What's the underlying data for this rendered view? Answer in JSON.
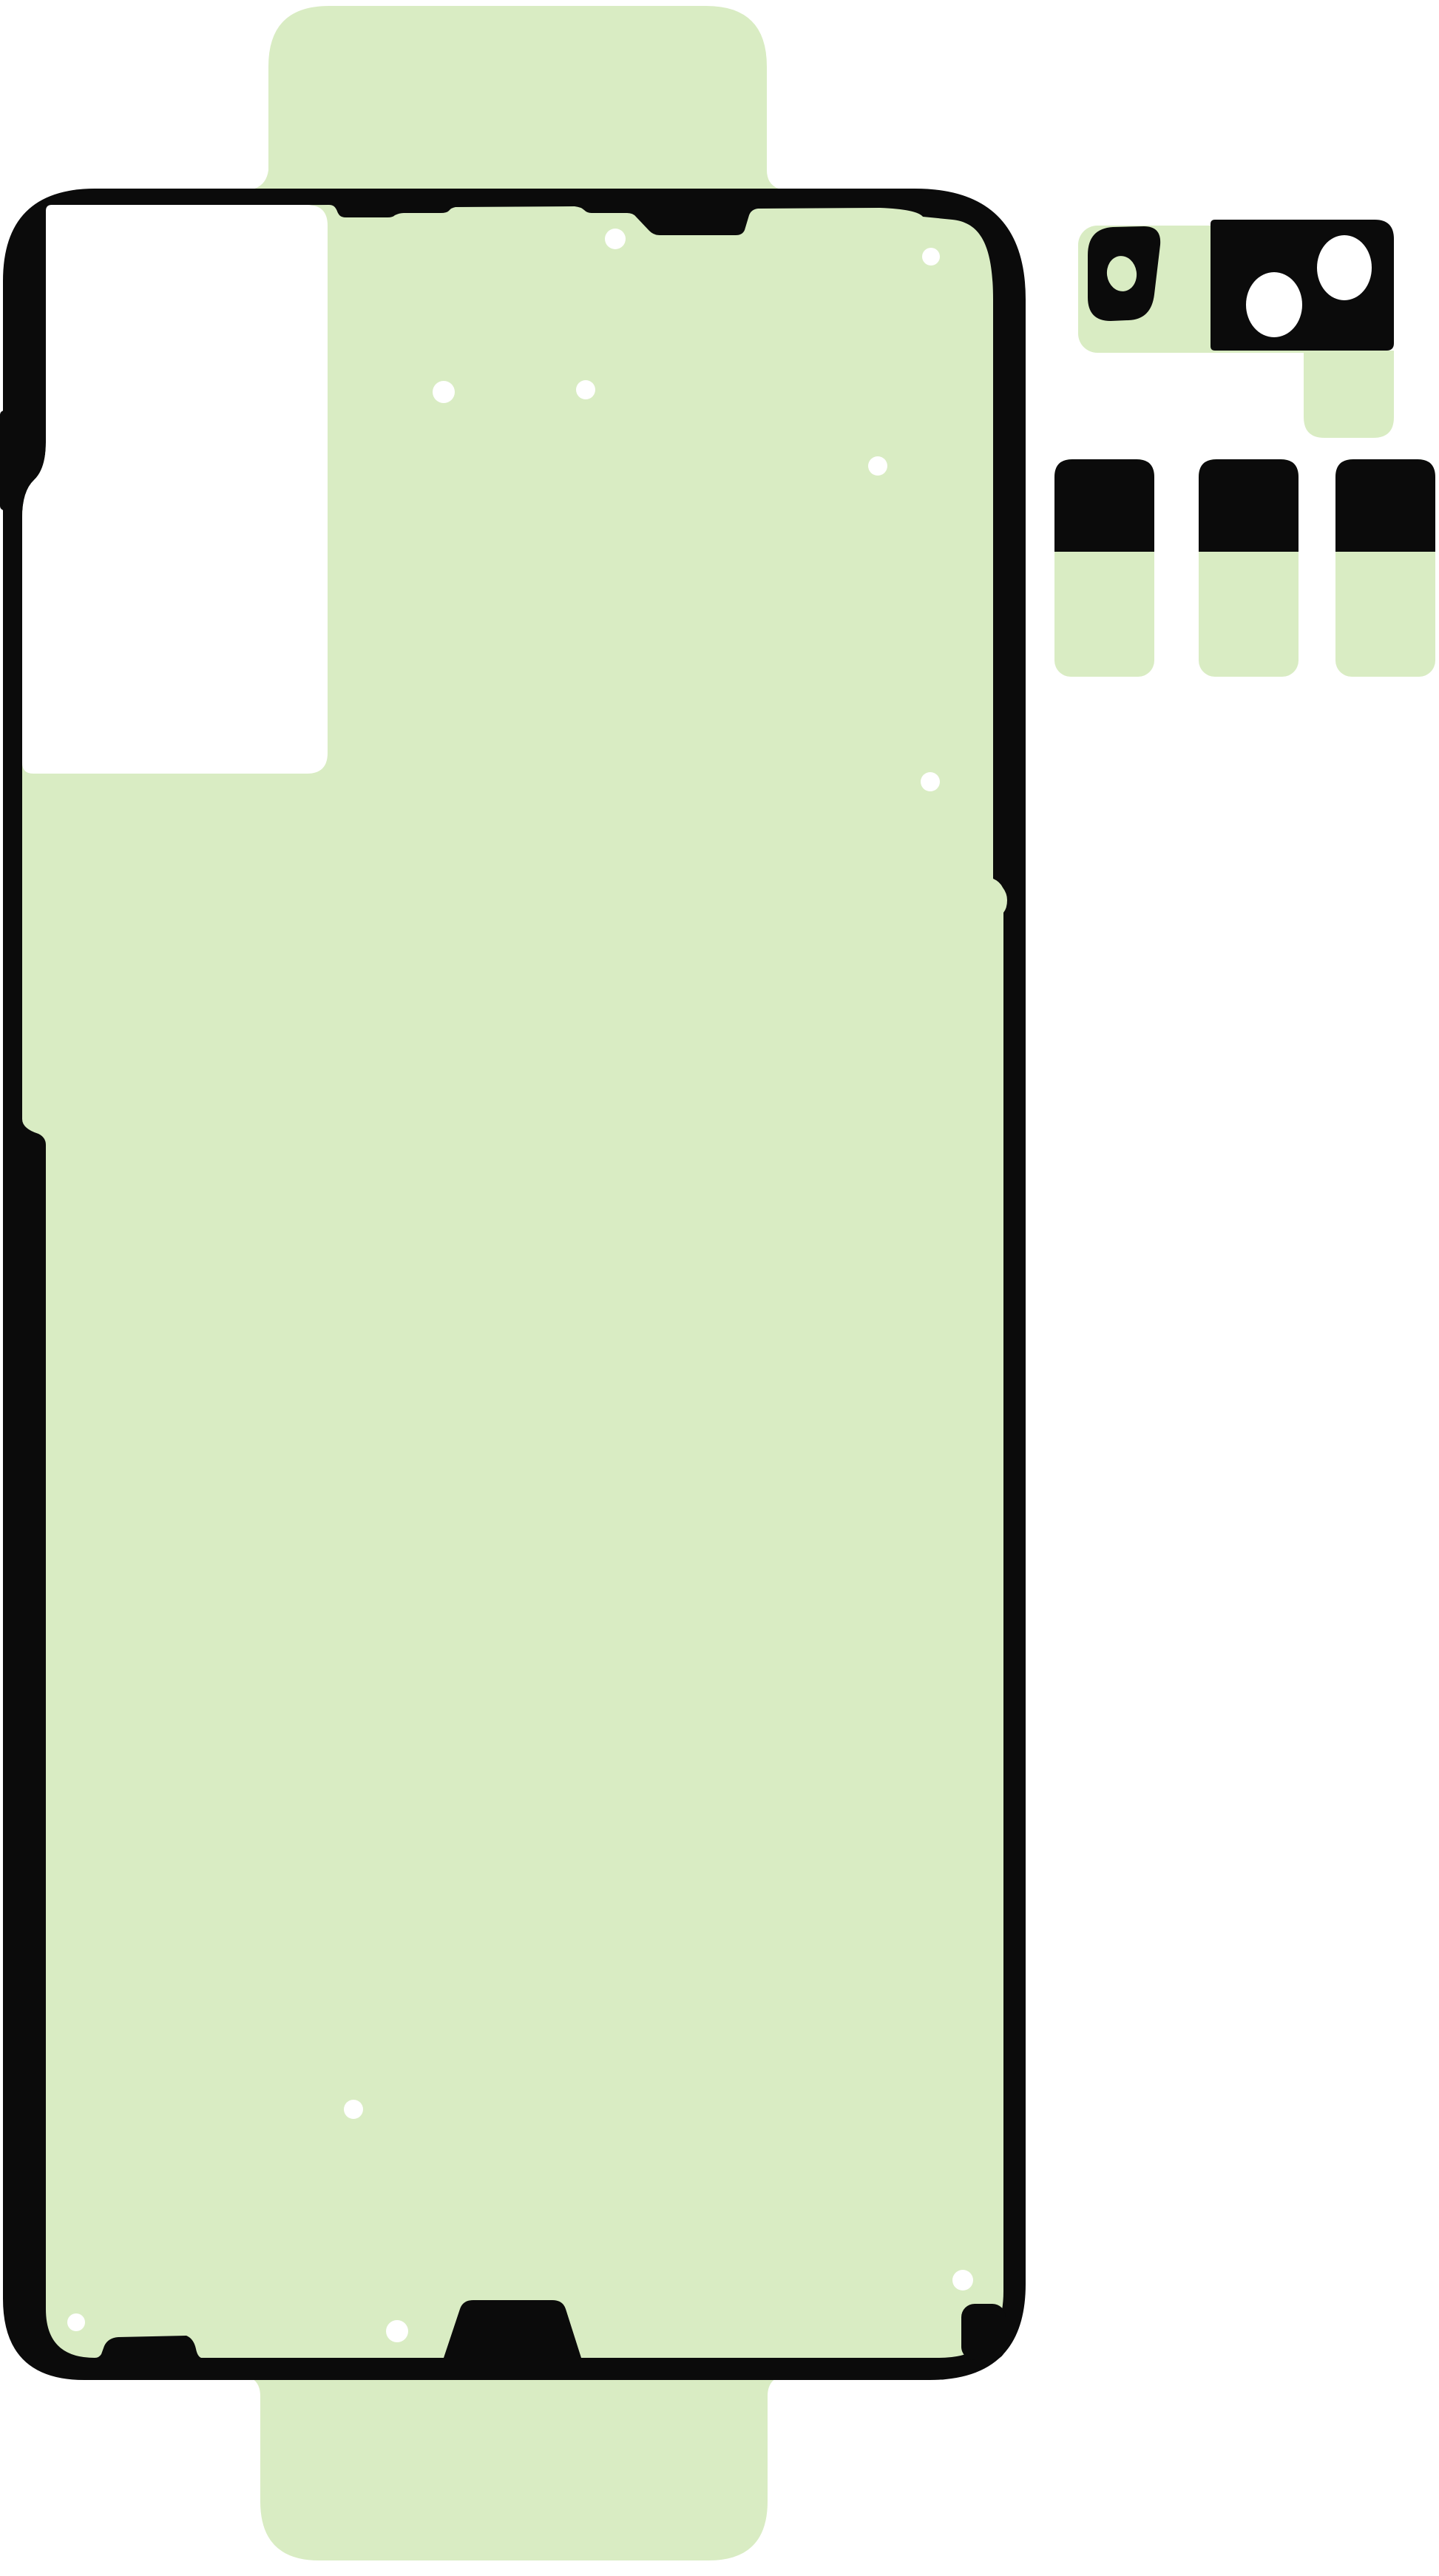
{
  "colors": {
    "background": "#ffffff",
    "liner_green": "#d9ecc3",
    "adhesive_black": "#0b0b0b",
    "hole_white": "#ffffff"
  },
  "illustration": {
    "kind": "smartphone-rear-cover-adhesive-kit",
    "parts": {
      "back_cover_adhesive": "rear cover gasket adhesive with peel liner tabs",
      "display_cutout_liner": "white liner window, upper left",
      "camera_adhesive": "camera and flash bezel adhesive, upper right",
      "pull_tab_strips": "3 adhesive pull strips",
      "alignment_holes": 10,
      "lens_holes": 3
    }
  }
}
